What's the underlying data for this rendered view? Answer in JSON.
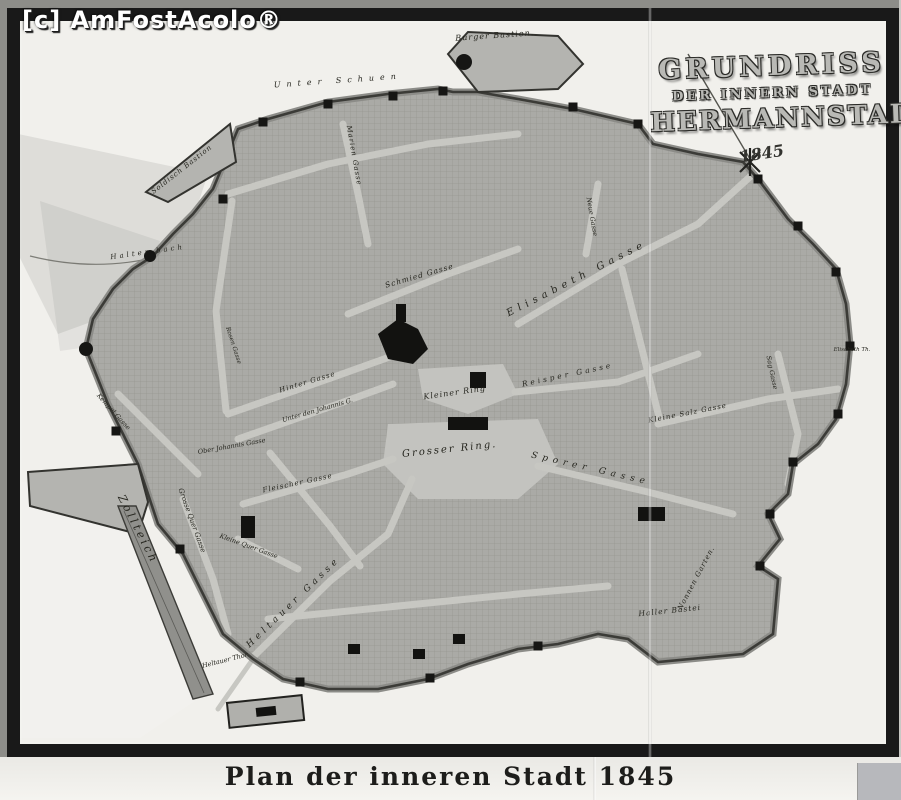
{
  "watermark": "[c] AmFostAcolo®",
  "photo": {
    "title": {
      "line1": "GRUNDRISS",
      "line2": "DER INNERN STADT",
      "line3": "HERMANNSTADT",
      "year": "1845"
    }
  },
  "caption": "Plan der inneren Stadt 1845",
  "colors": {
    "frame": "#191919",
    "paper": "#b2b2ae",
    "page": "#f1f0ec",
    "ink": "#2a2a26",
    "watermark_text": "#ffffff"
  },
  "map_labels": [
    {
      "id": "burger-bastion",
      "text": "Burger Bastion.",
      "x": 475,
      "y": 17,
      "r": -4,
      "s": 8,
      "sp": 1
    },
    {
      "id": "soldisch-bastion",
      "text": "Soldisch Bastion",
      "x": 163,
      "y": 150,
      "r": -38,
      "s": 7,
      "sp": 1
    },
    {
      "id": "halterbach",
      "text": "Halter bach",
      "x": 128,
      "y": 233,
      "r": -8,
      "s": 7,
      "sp": 3
    },
    {
      "id": "unter-schuen",
      "text": "Unter Schuen",
      "x": 318,
      "y": 62,
      "r": -4,
      "s": 8,
      "sp": 6
    },
    {
      "id": "marien-gasse",
      "text": "Marien Gasse",
      "x": 332,
      "y": 135,
      "r": 80,
      "s": 7,
      "sp": 1
    },
    {
      "id": "schmied-gasse",
      "text": "Schmied Gasse",
      "x": 400,
      "y": 257,
      "r": -16,
      "s": 7.5,
      "sp": 1
    },
    {
      "id": "elisabeth-gasse",
      "text": "Elisabeth Gasse",
      "x": 558,
      "y": 260,
      "r": -27,
      "s": 10,
      "sp": 5
    },
    {
      "id": "neue-gasse",
      "text": "Neue Gasse",
      "x": 570,
      "y": 196,
      "r": 80,
      "s": 6.5,
      "sp": 0
    },
    {
      "id": "hinter-gasse",
      "text": "Hinter Gasse",
      "x": 288,
      "y": 363,
      "r": -17,
      "s": 7,
      "sp": 1
    },
    {
      "id": "unter-johannis",
      "text": "Unter den Johannis G.",
      "x": 298,
      "y": 391,
      "r": -16,
      "s": 6.5,
      "sp": 0
    },
    {
      "id": "ober-johannis",
      "text": "Ober Johannis Gasse",
      "x": 212,
      "y": 427,
      "r": -10,
      "s": 6.5,
      "sp": 0
    },
    {
      "id": "kempel-gasse",
      "text": "Kempel Gasse",
      "x": 92,
      "y": 392,
      "r": 48,
      "s": 6.5,
      "sp": 0
    },
    {
      "id": "fleischer-gasse",
      "text": "Fleischer Gasse",
      "x": 278,
      "y": 464,
      "r": -12,
      "s": 7,
      "sp": 1
    },
    {
      "id": "grosser-ring",
      "text": "Grosser Ring.",
      "x": 430,
      "y": 431,
      "r": -6,
      "s": 10,
      "sp": 2
    },
    {
      "id": "kleiner-ring",
      "text": "Kleiner Ring",
      "x": 435,
      "y": 374,
      "r": -8,
      "s": 8,
      "sp": 1
    },
    {
      "id": "sporer-gasse",
      "text": "Sporer Gasse",
      "x": 570,
      "y": 450,
      "r": 13,
      "s": 9,
      "sp": 5
    },
    {
      "id": "kleine-salz-gasse",
      "text": "Kleine Salz Gasse",
      "x": 668,
      "y": 394,
      "r": -11,
      "s": 7,
      "sp": 1
    },
    {
      "id": "reisper-gasse",
      "text": "Reisper Gasse",
      "x": 548,
      "y": 356,
      "r": -12,
      "s": 7.5,
      "sp": 3
    },
    {
      "id": "heltauer-gasse",
      "text": "Heltauer Gasse",
      "x": 275,
      "y": 583,
      "r": -44,
      "s": 9,
      "sp": 4
    },
    {
      "id": "grosse-quer-gasse",
      "text": "Grosse Quer Gasse",
      "x": 170,
      "y": 500,
      "r": 70,
      "s": 7,
      "sp": 0
    },
    {
      "id": "kleine-quer-gasse",
      "text": "Kleine Quer Gasse",
      "x": 228,
      "y": 527,
      "r": 20,
      "s": 6.5,
      "sp": 0
    },
    {
      "id": "zollteich",
      "text": "Zollteich",
      "x": 115,
      "y": 510,
      "r": 63,
      "s": 11,
      "sp": 3
    },
    {
      "id": "heltauer-thor",
      "text": "Heltauer Thor.",
      "x": 206,
      "y": 641,
      "r": -14,
      "s": 6.5,
      "sp": 0
    },
    {
      "id": "nonnen-garten",
      "text": "Nonnen Garten.",
      "x": 678,
      "y": 558,
      "r": -62,
      "s": 7,
      "sp": 1
    },
    {
      "id": "haller-bastei",
      "text": "Haller Bastei",
      "x": 650,
      "y": 592,
      "r": -6,
      "s": 7.5,
      "sp": 1
    },
    {
      "id": "elisabeth-thor",
      "text": "Elisabeth Th.",
      "x": 832,
      "y": 330,
      "r": 0,
      "s": 5.5,
      "sp": 0
    },
    {
      "id": "sag-gasse",
      "text": "Sag Gasse",
      "x": 750,
      "y": 352,
      "r": 78,
      "s": 6.5,
      "sp": 0
    },
    {
      "id": "rosen-gasse",
      "text": "Rosen Gasse",
      "x": 212,
      "y": 325,
      "r": 72,
      "s": 6,
      "sp": 0
    }
  ]
}
